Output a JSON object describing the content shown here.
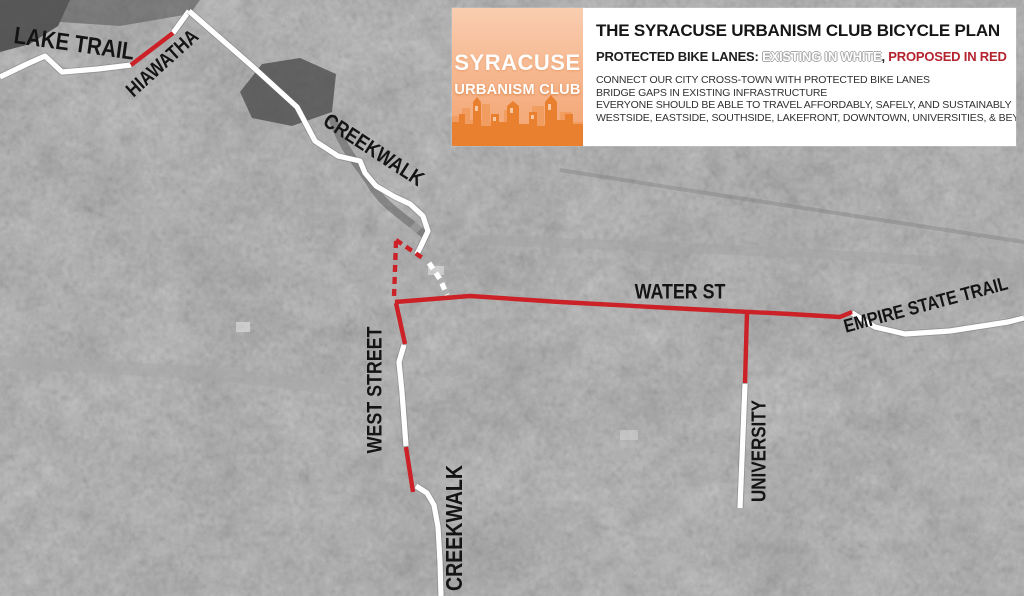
{
  "header": {
    "logo": {
      "line1": "SYRACUSE",
      "line2": "URBANISM CLUB"
    },
    "title": "THE SYRACUSE URBANISM CLUB BICYCLE PLAN",
    "legend": {
      "prefix": "PROTECTED BIKE LANES: ",
      "existing": "EXISTING IN WHITE",
      "separator": ", ",
      "proposed": "PROPOSED IN RED"
    },
    "bullets": [
      "CONNECT OUR CITY CROSS-TOWN WITH PROTECTED BIKE LANES",
      "BRIDGE GAPS IN EXISTING INFRASTRUCTURE",
      "EVERYONE SHOULD BE ABLE TO TRAVEL AFFORDABLY, SAFELY, AND SUSTAINABLY",
      "WESTSIDE, EASTSIDE, SOUTHSIDE, LAKEFRONT, DOWNTOWN, UNIVERSITIES, & BEYOND"
    ]
  },
  "colors": {
    "existing_line": "#ffffff",
    "proposed_line": "#cb2127",
    "proposed_text": "#b4232e",
    "label_text": "#141414",
    "logo_orange": "#e8802f"
  },
  "map": {
    "labels": [
      {
        "id": "lake-trail",
        "text": "LAKE TRAIL",
        "x": 74,
        "y": 45,
        "rotate": 8,
        "size": 24
      },
      {
        "id": "hiawatha",
        "text": "HIAWATHA",
        "x": 163,
        "y": 64,
        "rotate": -42,
        "size": 20
      },
      {
        "id": "creekwalk-north",
        "text": "CREEKWALK",
        "x": 373,
        "y": 151,
        "rotate": 33,
        "size": 21
      },
      {
        "id": "water-st",
        "text": "WATER ST",
        "x": 680,
        "y": 293,
        "rotate": 0,
        "size": 21
      },
      {
        "id": "empire-state-trail",
        "text": "EMPIRE STATE TRAIL",
        "x": 926,
        "y": 306,
        "rotate": -15,
        "size": 19
      },
      {
        "id": "west-street",
        "text": "WEST STREET",
        "x": 376,
        "y": 390,
        "rotate": -90,
        "size": 21
      },
      {
        "id": "university",
        "text": "UNIVERSITY",
        "x": 760,
        "y": 451,
        "rotate": -90,
        "size": 20
      },
      {
        "id": "creekwalk-south",
        "text": "CREEKWALK",
        "x": 456,
        "y": 528,
        "rotate": -90,
        "size": 23
      }
    ],
    "routes": [
      {
        "id": "lake-trail-line",
        "type": "existing",
        "dashed": false,
        "points": [
          [
            0,
            77
          ],
          [
            27,
            64
          ],
          [
            45,
            56
          ],
          [
            62,
            72
          ],
          [
            98,
            69
          ],
          [
            131,
            65
          ]
        ]
      },
      {
        "id": "hiawatha-proposed",
        "type": "proposed",
        "dashed": false,
        "points": [
          [
            131,
            65
          ],
          [
            173,
            33
          ]
        ]
      },
      {
        "id": "hiawatha-existing",
        "type": "existing",
        "dashed": false,
        "points": [
          [
            173,
            33
          ],
          [
            189,
            11
          ]
        ]
      },
      {
        "id": "creekwalk-north-line",
        "type": "existing",
        "dashed": false,
        "points": [
          [
            189,
            11
          ],
          [
            252,
            66
          ],
          [
            297,
            107
          ],
          [
            305,
            122
          ],
          [
            315,
            141
          ],
          [
            338,
            156
          ],
          [
            360,
            161
          ],
          [
            365,
            173
          ],
          [
            376,
            186
          ],
          [
            395,
            197
          ],
          [
            410,
            204
          ],
          [
            423,
            216
          ],
          [
            428,
            231
          ],
          [
            421,
            246
          ],
          [
            417,
            254
          ]
        ]
      },
      {
        "id": "creekwalk-gap-dashed",
        "type": "existing",
        "dashed": true,
        "points": [
          [
            429,
            263
          ],
          [
            440,
            279
          ],
          [
            447,
            295
          ]
        ]
      },
      {
        "id": "junction-connector-dashed",
        "type": "proposed",
        "dashed": true,
        "points": [
          [
            396,
            240
          ],
          [
            424,
            259
          ]
        ]
      },
      {
        "id": "west-street-gap-dashed",
        "type": "proposed",
        "dashed": true,
        "points": [
          [
            396,
            241
          ],
          [
            394,
            298
          ]
        ]
      },
      {
        "id": "water-st-line",
        "type": "proposed",
        "dashed": false,
        "points": [
          [
            395,
            302
          ],
          [
            470,
            296
          ],
          [
            560,
            302
          ],
          [
            690,
            309
          ],
          [
            790,
            314
          ],
          [
            840,
            317
          ],
          [
            852,
            312
          ]
        ]
      },
      {
        "id": "west-street-proposed-north",
        "type": "proposed",
        "dashed": false,
        "points": [
          [
            396,
            303
          ],
          [
            405,
            344
          ]
        ]
      },
      {
        "id": "west-street-existing",
        "type": "existing",
        "dashed": false,
        "points": [
          [
            404,
            345
          ],
          [
            399,
            362
          ],
          [
            402,
            392
          ],
          [
            406,
            446
          ]
        ]
      },
      {
        "id": "west-street-proposed-south",
        "type": "proposed",
        "dashed": false,
        "points": [
          [
            406,
            447
          ],
          [
            413,
            492
          ]
        ]
      },
      {
        "id": "creekwalk-south-line",
        "type": "existing",
        "dashed": false,
        "points": [
          [
            416,
            486
          ],
          [
            427,
            493
          ],
          [
            434,
            505
          ],
          [
            438,
            527
          ],
          [
            440,
            562
          ],
          [
            441,
            596
          ]
        ]
      },
      {
        "id": "university-proposed",
        "type": "proposed",
        "dashed": false,
        "points": [
          [
            747,
            312
          ],
          [
            745,
            383
          ]
        ]
      },
      {
        "id": "university-existing",
        "type": "existing",
        "dashed": false,
        "points": [
          [
            745,
            384
          ],
          [
            740,
            508
          ]
        ]
      },
      {
        "id": "empire-state-trail-line",
        "type": "existing",
        "dashed": false,
        "points": [
          [
            852,
            313
          ],
          [
            875,
            327
          ],
          [
            905,
            334
          ],
          [
            950,
            331
          ],
          [
            1008,
            322
          ],
          [
            1024,
            318
          ]
        ]
      }
    ]
  }
}
